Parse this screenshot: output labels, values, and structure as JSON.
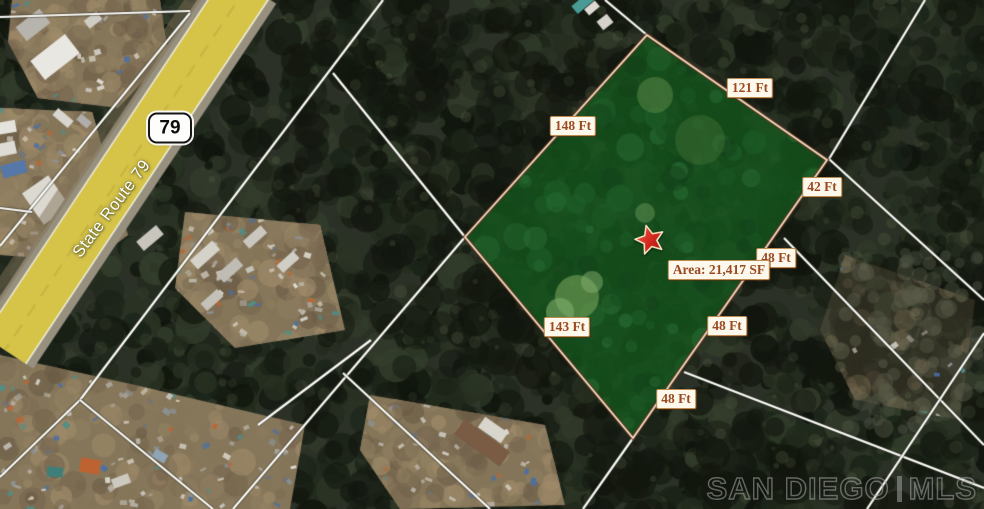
{
  "map": {
    "route_shield": "79",
    "road_name": "State Route 79",
    "road_highlight_color": "#d9c84b"
  },
  "parcel": {
    "area_label": "Area: 21,417 SF",
    "measurements": [
      {
        "side": "upper-left",
        "text": "148 Ft"
      },
      {
        "side": "upper-right",
        "text": "121 Ft"
      },
      {
        "side": "right",
        "text": "42 Ft"
      },
      {
        "side": "right-2",
        "text": "48 Ft"
      },
      {
        "side": "right-3",
        "text": "48 Ft"
      },
      {
        "side": "right-4",
        "text": "48 Ft"
      },
      {
        "side": "lower-left",
        "text": "143 Ft"
      }
    ],
    "highlight_color": "#14581e",
    "border_color": "#f4e0c2",
    "border_shadow_color": "#5e2f1e",
    "label_text_color": "#9a4920",
    "marker_color": "#d2281e"
  },
  "watermark": {
    "brand": "SAN DIEGO",
    "suffix": "MLS"
  }
}
